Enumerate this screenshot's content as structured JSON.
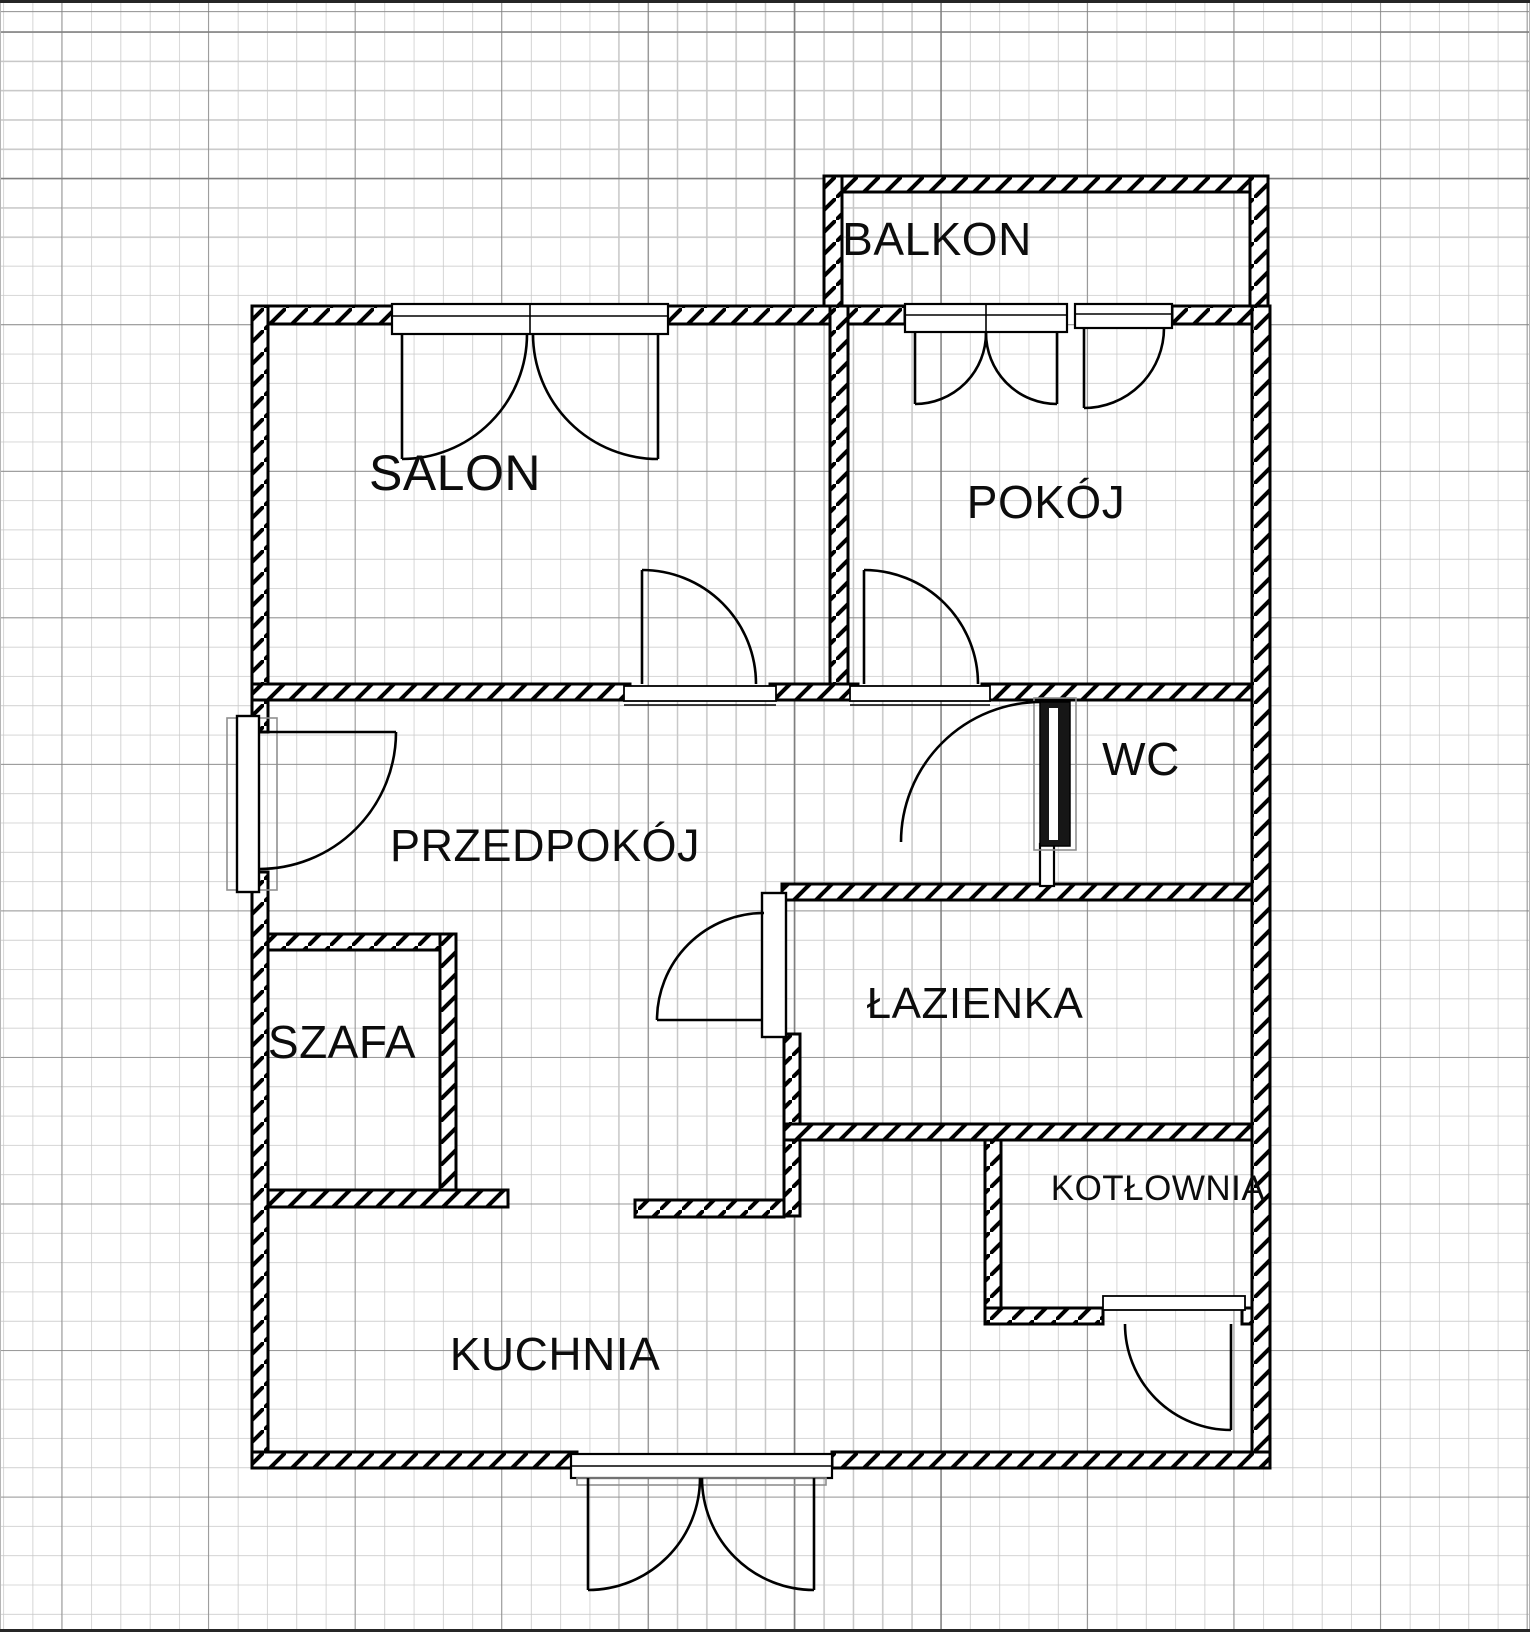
{
  "document": {
    "type": "apartment-floor-plan",
    "language": "pl"
  },
  "grid": {
    "paper_color": "#ffffff",
    "minor_spacing_px": 29.3,
    "major_spacing_px": 146.5,
    "minor_color": "#c8c8c8",
    "major_color": "#7f7f7f",
    "edge_line_color": "#262626"
  },
  "plan": {
    "wall_color": "#000000",
    "rooms": [
      {
        "id": "balkon",
        "label": "BALKON"
      },
      {
        "id": "salon",
        "label": "SALON"
      },
      {
        "id": "pokoj",
        "label": "POKÓJ"
      },
      {
        "id": "wc",
        "label": "WC"
      },
      {
        "id": "przedpokoj",
        "label": "PRZEDPOKÓJ"
      },
      {
        "id": "szafa",
        "label": "SZAFA"
      },
      {
        "id": "lazienka",
        "label": "ŁAZIENKA"
      },
      {
        "id": "kotlownia",
        "label": "KOTŁOWNIA"
      },
      {
        "id": "kuchnia",
        "label": "KUCHNIA"
      }
    ]
  }
}
